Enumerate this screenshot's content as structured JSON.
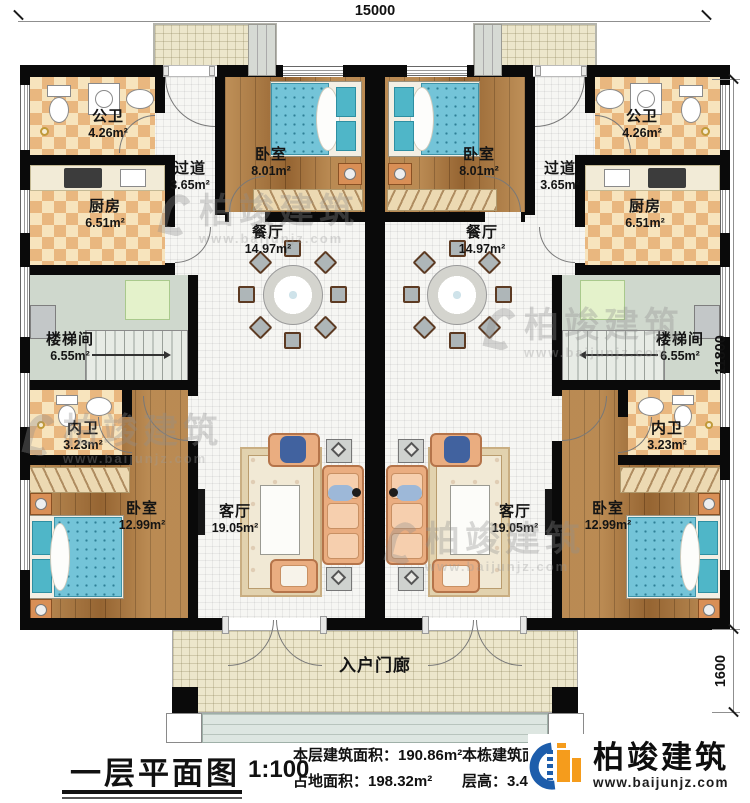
{
  "plan": {
    "dimensions": {
      "top": "15000",
      "side_main": "11800",
      "side_porch": "1600"
    },
    "rooms": {
      "gongwei": {
        "name": "公卫",
        "area": "4.26m²"
      },
      "guodao": {
        "name": "过道",
        "area": "3.65m²"
      },
      "woshi_top": {
        "name": "卧室",
        "area": "8.01m²"
      },
      "chufang": {
        "name": "厨房",
        "area": "6.51m²"
      },
      "canting": {
        "name": "餐厅",
        "area": "14.97m²"
      },
      "loutijian": {
        "name": "楼梯间",
        "area": "6.55m²"
      },
      "neiwei": {
        "name": "内卫",
        "area": "3.23m²"
      },
      "woshi_main": {
        "name": "卧室",
        "area": "12.99m²"
      },
      "keting": {
        "name": "客厅",
        "area": "19.05m²"
      },
      "porch": {
        "name": "入户门廊"
      }
    }
  },
  "titleblock": {
    "title": "一层平面图",
    "scale": "1:100",
    "floor_area": "本层建筑面积：190.86m²",
    "site_area": "占地面积：198.32m²",
    "total_area_label": "本栋建筑面积：",
    "storey_height": "层高：3.45M"
  },
  "brand": {
    "name": "柏竣建筑",
    "url": "www.baijunjz.com",
    "blue": "#1d5dab",
    "orange": "#f59c1c"
  },
  "watermark": {
    "name": "柏竣建筑",
    "url": "www.baijunjz.com",
    "color": "#8f8f8f"
  }
}
